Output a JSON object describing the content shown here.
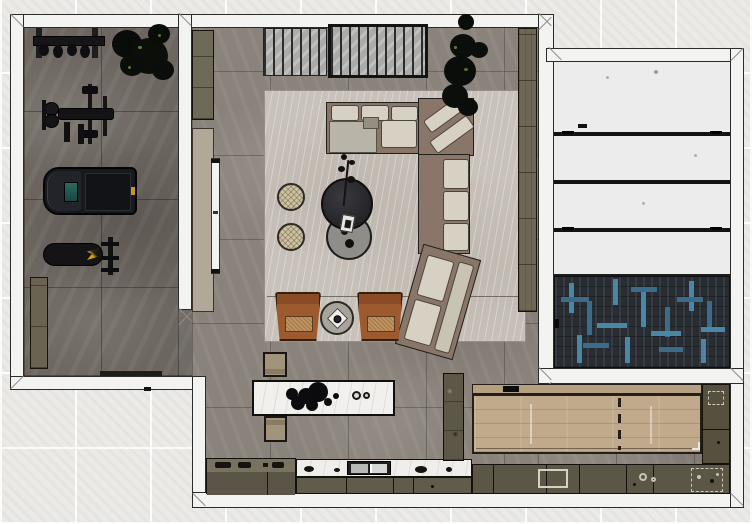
{
  "scene": {
    "description": "Top-down 3D rendered floor plan of an apartment with home gym, living room, kitchen, dining area and annex room",
    "view": "plan-top-view",
    "background": "light tiled exterior floor"
  },
  "rooms": {
    "gym": "Home gym",
    "living": "Living room",
    "kitchen": "Kitchen",
    "dining": "Dining area",
    "annex": "Annex room with paneled area and herringbone rug"
  },
  "furniture": {
    "gym": [
      "barbell-rack",
      "potted-plant",
      "bench-press-station",
      "treadmill",
      "weight-bench",
      "storage-cabinet"
    ],
    "living": [
      "tv-cabinet",
      "media-wall-panel",
      "tv-screen",
      "louvered-panels",
      "area-rug",
      "sectional-sofa",
      "corner-chaise",
      "large-plant",
      "round-coffee-table-dark",
      "round-coffee-table-gray",
      "pouf",
      "pouf",
      "armchair",
      "armchair",
      "round-side-table",
      "shelf-unit"
    ],
    "kitchen": [
      "island-with-marble-top",
      "stool-bench",
      "stool-bench",
      "counter-left",
      "marble-counter-with-sink",
      "tall-cabinet"
    ],
    "dining": [
      "wood-dining-table",
      "wood-bench",
      "counter-run",
      "counter-column"
    ],
    "annex": [
      "white-panel-sections",
      "herringbone-rug"
    ]
  },
  "palette": {
    "wall": "#f3f3f1",
    "outline": "#2b2b29",
    "gym_floor": "#6d6660",
    "main_floor": "#8a837b",
    "rug": "#c9c2ba",
    "sofa_frame": "#8a7668",
    "cushion": "#d7d1c3",
    "chaise_pad": "#b8b4a7",
    "armchair_rust": "#9d5a2e",
    "armchair_seat": "#c1935f",
    "olive_cabinet": "#6b6352",
    "marble": "#f1f0ec",
    "wood": "#c0aa8b",
    "herringbone_base": "#282d33",
    "herringbone_accent": "#4a86a6",
    "panel_white": "#ececec",
    "treadmill_screen": "#2c6a63",
    "accent_yellow": "#c79a1e",
    "plant_foliage": "#0b0d09",
    "exterior_tile": "#ebeae7"
  }
}
